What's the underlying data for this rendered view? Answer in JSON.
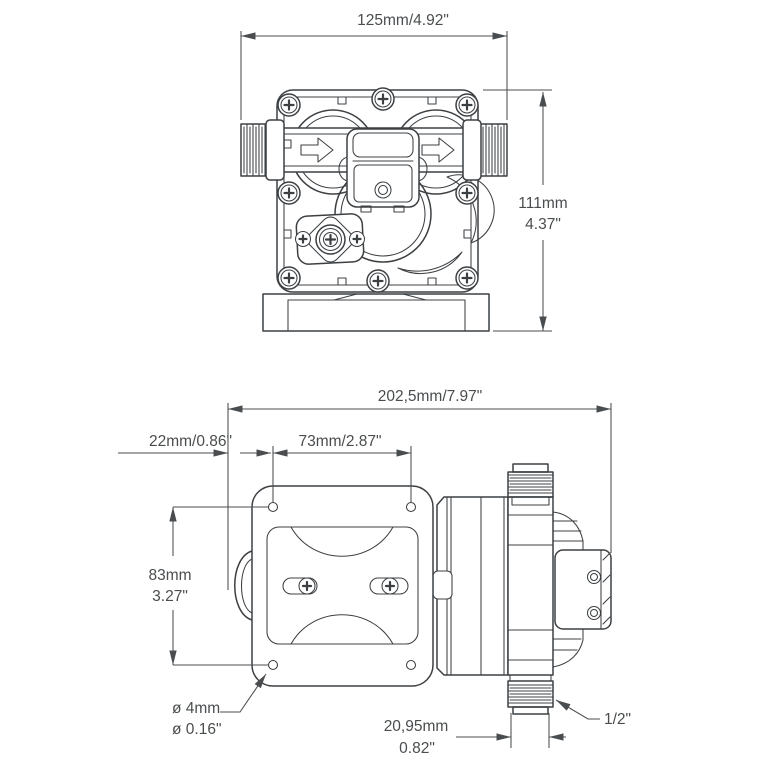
{
  "colors": {
    "background": "#ffffff",
    "line": "#3d4043",
    "dim_line": "#4a4d4f",
    "text": "#4a4d4f"
  },
  "front_view": {
    "dim_width": "125mm/4.92\"",
    "dim_height_mm": "111mm",
    "dim_height_in": "4.37\""
  },
  "side_view": {
    "dim_overall": "202,5mm/7.97\"",
    "dim_offset": "22mm/0.86\"",
    "dim_hole_spacing": "73mm/2.87\"",
    "dim_height_mm": "83mm",
    "dim_height_in": "3.27\"",
    "dim_hole_mm": "ø 4mm",
    "dim_hole_in": "ø 0.16\"",
    "dim_port_mm": "20,95mm",
    "dim_port_in": "0.82\"",
    "dim_port_size": "1/2\""
  }
}
